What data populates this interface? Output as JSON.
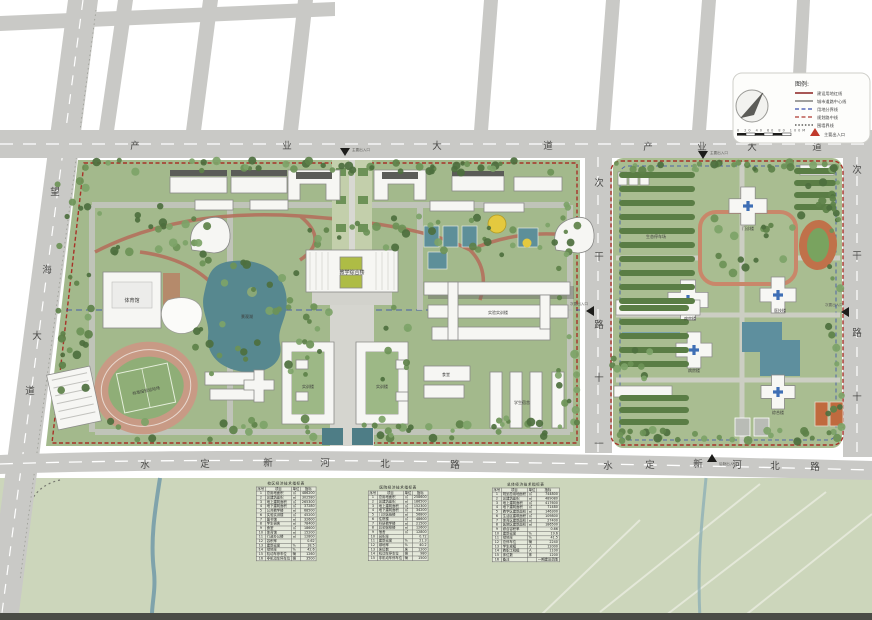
{
  "roads": {
    "top_avenue_left": [
      "产",
      "业",
      "大",
      "道"
    ],
    "top_avenue_right": [
      "产",
      "业",
      "大",
      "道"
    ],
    "bottom_road_left": [
      "水",
      "定",
      "新",
      "河",
      "北",
      "路"
    ],
    "bottom_road_right": [
      "水",
      "定",
      "新",
      "河",
      "北",
      "路"
    ],
    "left_avenue": [
      "望",
      "海",
      "大",
      "道"
    ],
    "middle_road": [
      "次",
      "干",
      "路",
      "十",
      "一"
    ],
    "right_road": [
      "次",
      "干",
      "路",
      "十"
    ]
  },
  "legend": {
    "title": "图例:",
    "items": [
      {
        "label": "建设用地红线"
      },
      {
        "label": "城市道路中心线"
      },
      {
        "label": "用地分界线"
      },
      {
        "label": "规划路中线"
      },
      {
        "label": "围墙界线"
      }
    ],
    "entrance_marker": "主要出入口",
    "scale_numbers": "0  20  40  60  80  100M"
  },
  "gates": {
    "main": "主要出入口",
    "secondary": "次要出入口",
    "service": "后勤出入口"
  },
  "labels": {
    "gym": "体育馆",
    "stadium": "标准田径运动场",
    "main_building": "教学综合楼",
    "e_complex": "实验实训楼",
    "dorm": "学生宿舍",
    "canteen": "食堂",
    "lab_a": "实训楼",
    "lab_b": "实训楼",
    "lake": "景观湖",
    "outpatient": "门诊楼",
    "ward_a": "病房楼",
    "ward_b": "医技楼",
    "ward_c": "病房楼",
    "rehab": "综合楼",
    "eco_parking": "生态停车场"
  },
  "tables": [
    {
      "title": "校区经济技术指标表",
      "headers": [
        "序号",
        "项目",
        "单位",
        "指标"
      ],
      "rows": [
        [
          "1",
          "总用地面积",
          "㎡",
          "486200"
        ],
        [
          "2",
          "总建筑面积",
          "㎡",
          "302580"
        ],
        [
          "3",
          "地上建筑面积",
          "㎡",
          "265300"
        ],
        [
          "4",
          "地下建筑面积",
          "㎡",
          "37280"
        ],
        [
          "5",
          "公共教学楼",
          "㎡",
          "68500"
        ],
        [
          "6",
          "实验实训楼",
          "㎡",
          "45200"
        ],
        [
          "7",
          "图书馆",
          "㎡",
          "32600"
        ],
        [
          "8",
          "学生宿舍",
          "㎡",
          "78400"
        ],
        [
          "9",
          "食堂",
          "㎡",
          "18600"
        ],
        [
          "10",
          "体育馆",
          "㎡",
          "15200"
        ],
        [
          "11",
          "行政办公楼",
          "㎡",
          "12800"
        ],
        [
          "12",
          "容积率",
          "",
          "0.62"
        ],
        [
          "13",
          "建筑密度",
          "%",
          "18.5"
        ],
        [
          "14",
          "绿地率",
          "%",
          "42.6"
        ],
        [
          "15",
          "机动车停车位",
          "辆",
          "1260"
        ],
        [
          "16",
          "非机动车停车位",
          "辆",
          "3500"
        ]
      ]
    },
    {
      "title": "医院经济技术指标表",
      "headers": [
        "序号",
        "项目",
        "单位",
        "指标"
      ],
      "rows": [
        [
          "1",
          "总用地面积",
          "㎡",
          "258600"
        ],
        [
          "2",
          "总建筑面积",
          "㎡",
          "186500"
        ],
        [
          "3",
          "地上建筑面积",
          "㎡",
          "152300"
        ],
        [
          "4",
          "地下建筑面积",
          "㎡",
          "34200"
        ],
        [
          "5",
          "门诊医技楼",
          "㎡",
          "56800"
        ],
        [
          "6",
          "住院楼",
          "㎡",
          "48600"
        ],
        [
          "7",
          "科研教学楼",
          "㎡",
          "21500"
        ],
        [
          "8",
          "后勤保障楼",
          "㎡",
          "12600"
        ],
        [
          "9",
          "宿舍",
          "㎡",
          "12800"
        ],
        [
          "10",
          "容积率",
          "",
          "0.72"
        ],
        [
          "11",
          "建筑密度",
          "%",
          "21.3"
        ],
        [
          "12",
          "绿地率",
          "%",
          "40.2"
        ],
        [
          "13",
          "床位数",
          "床",
          "1200"
        ],
        [
          "14",
          "机动车停车位",
          "辆",
          "980"
        ],
        [
          "15",
          "非机动车停车位",
          "辆",
          "1500"
        ]
      ]
    },
    {
      "title": "总体经济技术指标表",
      "headers": [
        "序号",
        "项目",
        "单位",
        "指标"
      ],
      "rows": [
        [
          "1",
          "规划总用地面积",
          "㎡",
          "744800"
        ],
        [
          "2",
          "总建筑面积",
          "㎡",
          "489080"
        ],
        [
          "3",
          "地上建筑面积",
          "㎡",
          "417600"
        ],
        [
          "4",
          "地下建筑面积",
          "㎡",
          "71480"
        ],
        [
          "5",
          "教学区建筑面积",
          "㎡",
          "146300"
        ],
        [
          "6",
          "生活区建筑面积",
          "㎡",
          "109800"
        ],
        [
          "7",
          "体育区建筑面积",
          "㎡",
          "27400"
        ],
        [
          "8",
          "医院区建筑面积",
          "㎡",
          "186500"
        ],
        [
          "9",
          "综合容积率",
          "",
          "0.66"
        ],
        [
          "10",
          "建筑密度",
          "%",
          "19.6"
        ],
        [
          "11",
          "绿地率",
          "%",
          "41.5"
        ],
        [
          "12",
          "总停车位",
          "辆",
          "2240"
        ],
        [
          "13",
          "学生规模",
          "人",
          "12000"
        ],
        [
          "14",
          "教职工规模",
          "人",
          "1100"
        ],
        [
          "15",
          "床位数",
          "床",
          "1200"
        ],
        [
          "16",
          "备注",
          "",
          "一期建设范围"
        ]
      ]
    }
  ],
  "colors": {
    "road": "#c9c9c6",
    "campus_green": "#a3b98c",
    "campus_green_right": "#a9bd91",
    "tree_dark": "#4d6f3e",
    "water": "#57888f",
    "red_line": "#a83228",
    "blue_line": "#3a4fae",
    "track_tan": "#c89a85",
    "court_orange": "#c06a3e",
    "building": "#f6f6f3"
  }
}
